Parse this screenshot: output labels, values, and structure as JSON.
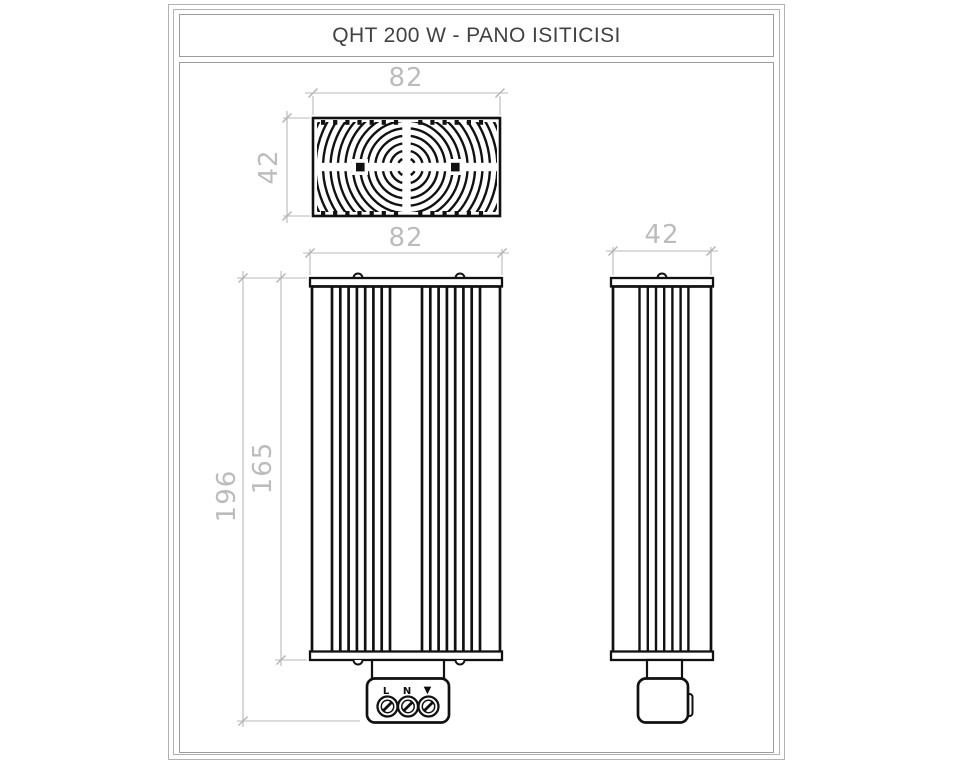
{
  "title": "QHT 200 W - PANO ISITICISI",
  "dimensions": {
    "top_view_width": "82",
    "top_view_depth": "42",
    "front_view_width": "82",
    "front_body_height": "165",
    "front_total_height": "196",
    "side_view_depth": "42"
  },
  "terminal_block": {
    "line_label": "L",
    "neutral_label": "N",
    "ground_symbol": "▼"
  },
  "colors": {
    "drawing_line": "#111111",
    "dimension": "#bcbcbc",
    "frame_border": "#9c9c9c",
    "title_text": "#414141",
    "background": "#ffffff"
  }
}
